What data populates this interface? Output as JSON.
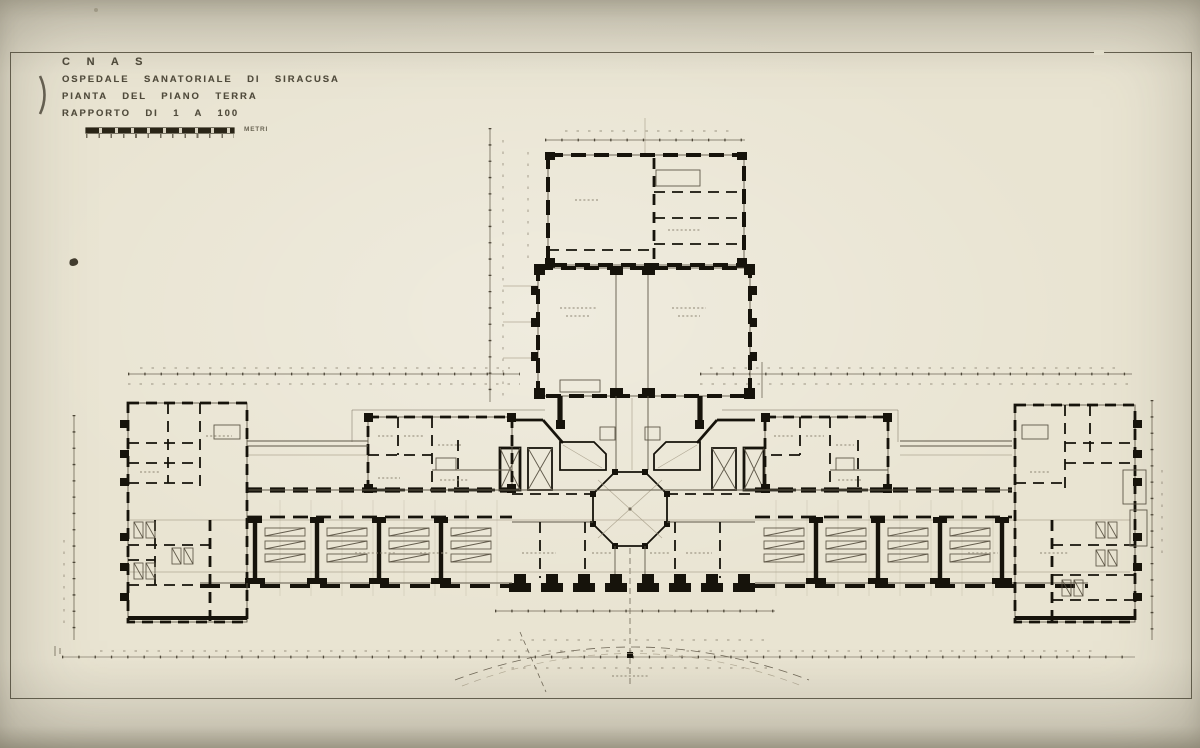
{
  "title_block": {
    "organization": "C N A S",
    "drawing_title": "OSPEDALE SANATORIALE DI SIRACUSA",
    "sheet_subtitle": "PIANTA DEL PIANO TERRA",
    "scale_note": "RAPPORTO DI 1 A 100",
    "scale_bar_unit": "METRI"
  },
  "palette": {
    "mount": "#d8d3c2",
    "paper": "#e9e4d2",
    "paper_shadow": "#cfc9b5",
    "ink": "#16130b",
    "frame": "#4f4a39",
    "faint": "#a79e88",
    "medium": "#6f6757"
  }
}
